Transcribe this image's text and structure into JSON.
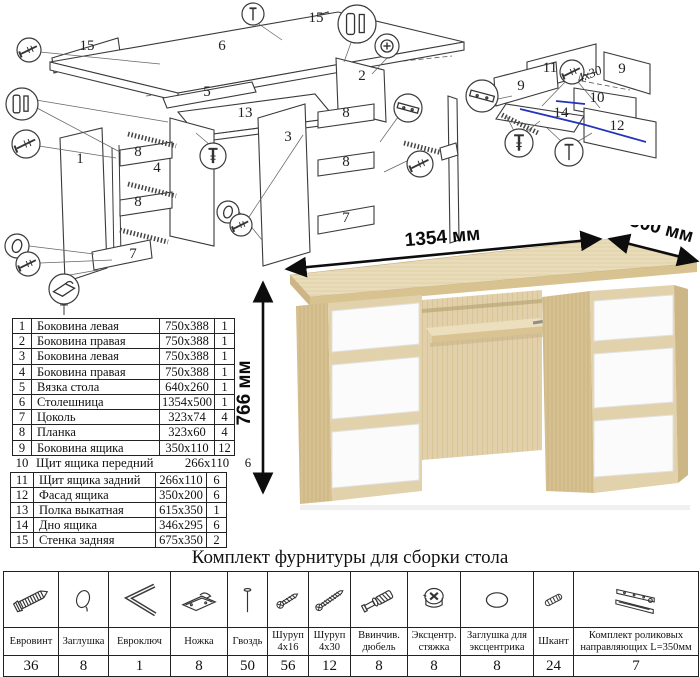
{
  "colors": {
    "wood_top": "#e9dcba",
    "wood_side": "#d6c090",
    "wood_edge": "#cdb685",
    "drawer_white": "#fbfbfb",
    "diagram_line": "#3a3a3a",
    "highlight_blue": "#2233bb",
    "dimension_black": "#111111"
  },
  "assembly_diagram": {
    "part_labels": [
      {
        "t": "15",
        "x": 87,
        "y": 50
      },
      {
        "t": "6",
        "x": 222,
        "y": 50
      },
      {
        "t": "15",
        "x": 316,
        "y": 22
      },
      {
        "t": "5",
        "x": 207,
        "y": 96
      },
      {
        "t": "13",
        "x": 245,
        "y": 117
      },
      {
        "t": "1",
        "x": 80,
        "y": 163
      },
      {
        "t": "3",
        "x": 288,
        "y": 141
      },
      {
        "t": "4",
        "x": 157,
        "y": 172
      },
      {
        "t": "8",
        "x": 138,
        "y": 156
      },
      {
        "t": "8",
        "x": 138,
        "y": 206
      },
      {
        "t": "7",
        "x": 133,
        "y": 258
      },
      {
        "t": "2",
        "x": 362,
        "y": 80
      },
      {
        "t": "8",
        "x": 346,
        "y": 117
      },
      {
        "t": "8",
        "x": 346,
        "y": 166
      },
      {
        "t": "7",
        "x": 346,
        "y": 222
      }
    ],
    "drawer_labels": [
      {
        "t": "11",
        "x": 550,
        "y": 72
      },
      {
        "t": "9",
        "x": 521,
        "y": 90
      },
      {
        "t": "9",
        "x": 622,
        "y": 73
      },
      {
        "t": "10",
        "x": 597,
        "y": 102
      },
      {
        "t": "14",
        "x": 561,
        "y": 117
      },
      {
        "t": "12",
        "x": 617,
        "y": 130
      }
    ],
    "screw_note": "4x30",
    "callouts": [
      {
        "glyph": "screw",
        "x": 29,
        "y": 50,
        "r": 12
      },
      {
        "glyph": "dowel",
        "x": 22,
        "y": 104,
        "r": 16
      },
      {
        "glyph": "screw",
        "x": 26,
        "y": 144,
        "r": 14
      },
      {
        "glyph": "cap",
        "x": 17,
        "y": 246,
        "r": 12
      },
      {
        "glyph": "screw",
        "x": 28,
        "y": 264,
        "r": 12
      },
      {
        "glyph": "foot",
        "x": 64,
        "y": 289,
        "r": 15
      },
      {
        "glyph": "bolt",
        "x": 213,
        "y": 156,
        "r": 13
      },
      {
        "glyph": "cap",
        "x": 228,
        "y": 212,
        "r": 11
      },
      {
        "glyph": "screw",
        "x": 241,
        "y": 225,
        "r": 11
      },
      {
        "glyph": "nail",
        "x": 253,
        "y": 14,
        "r": 11
      },
      {
        "glyph": "dowel",
        "x": 357,
        "y": 24,
        "r": 19
      },
      {
        "glyph": "ecc",
        "x": 387,
        "y": 46,
        "r": 12
      },
      {
        "glyph": "rail",
        "x": 408,
        "y": 108,
        "r": 14
      },
      {
        "glyph": "screw",
        "x": 420,
        "y": 164,
        "r": 13
      },
      {
        "glyph": "rail",
        "x": 482,
        "y": 96,
        "r": 16
      },
      {
        "glyph": "bolt",
        "x": 519,
        "y": 143,
        "r": 14
      },
      {
        "glyph": "nail",
        "x": 569,
        "y": 152,
        "r": 14
      },
      {
        "glyph": "screw",
        "x": 572,
        "y": 72,
        "r": 12
      }
    ]
  },
  "parts_table": {
    "rows": [
      {
        "n": "1",
        "name": "Боковина левая",
        "size": "750x388",
        "qty": "1"
      },
      {
        "n": "2",
        "name": "Боковина правая",
        "size": "750x388",
        "qty": "1"
      },
      {
        "n": "3",
        "name": "Боковина левая",
        "size": "750x388",
        "qty": "1"
      },
      {
        "n": "4",
        "name": "Боковина правая",
        "size": "750x388",
        "qty": "1"
      },
      {
        "n": "5",
        "name": "Вязка стола",
        "size": "640x260",
        "qty": "1"
      },
      {
        "n": "6",
        "name": "Столешница",
        "size": "1354x500",
        "qty": "1"
      },
      {
        "n": "7",
        "name": "Цоколь",
        "size": "323x74",
        "qty": "4"
      },
      {
        "n": "8",
        "name": "Планка",
        "size": "323x60",
        "qty": "4"
      },
      {
        "n": "9",
        "name": "Боковина ящика",
        "size": "350x110",
        "qty": "12"
      },
      {
        "n": "10",
        "name": "Щит ящика передний",
        "size": "266x110",
        "qty": "6"
      },
      {
        "n": "11",
        "name": "Щит ящика задний",
        "size": "266x110",
        "qty": "6"
      },
      {
        "n": "12",
        "name": "Фасад ящика",
        "size": "350x200",
        "qty": "6"
      },
      {
        "n": "13",
        "name": "Полка выкатная",
        "size": "615x350",
        "qty": "1"
      },
      {
        "n": "14",
        "name": "Дно ящика",
        "size": "346x295",
        "qty": "6"
      },
      {
        "n": "15",
        "name": "Стенка задняя",
        "size": "675x350",
        "qty": "2"
      }
    ]
  },
  "desk": {
    "width_label": "1354 мм",
    "depth_label": "500 мм",
    "height_label": "766 мм"
  },
  "hardware": {
    "title": "Комплект фурнитуры для сборки стола",
    "items": [
      {
        "icon": "euroscrew",
        "name": "Евровинт",
        "qty": "36"
      },
      {
        "icon": "cap",
        "name": "Заглушка",
        "qty": "8"
      },
      {
        "icon": "hexkey",
        "name": "Евроключ",
        "qty": "1"
      },
      {
        "icon": "foot",
        "name": "Ножка",
        "qty": "8"
      },
      {
        "icon": "nail",
        "name": "Гвоздь",
        "qty": "50"
      },
      {
        "icon": "screw-short",
        "name": "Шуруп\n4x16",
        "qty": "56"
      },
      {
        "icon": "screw-long",
        "name": "Шуруп\n4x30",
        "qty": "12"
      },
      {
        "icon": "dowel-screw",
        "name": "Ввинчив.\nдюбель",
        "qty": "8"
      },
      {
        "icon": "eccentric",
        "name": "Эксцентр.\nстяжка",
        "qty": "8"
      },
      {
        "icon": "cap-ecc",
        "name": "Заглушка для\nэксцентрика",
        "qty": "8"
      },
      {
        "icon": "shkant",
        "name": "Шкант",
        "qty": "24"
      },
      {
        "icon": "rails",
        "name": "Комплект роликовых\nнаправляющих L=350мм",
        "qty": "7"
      }
    ]
  }
}
